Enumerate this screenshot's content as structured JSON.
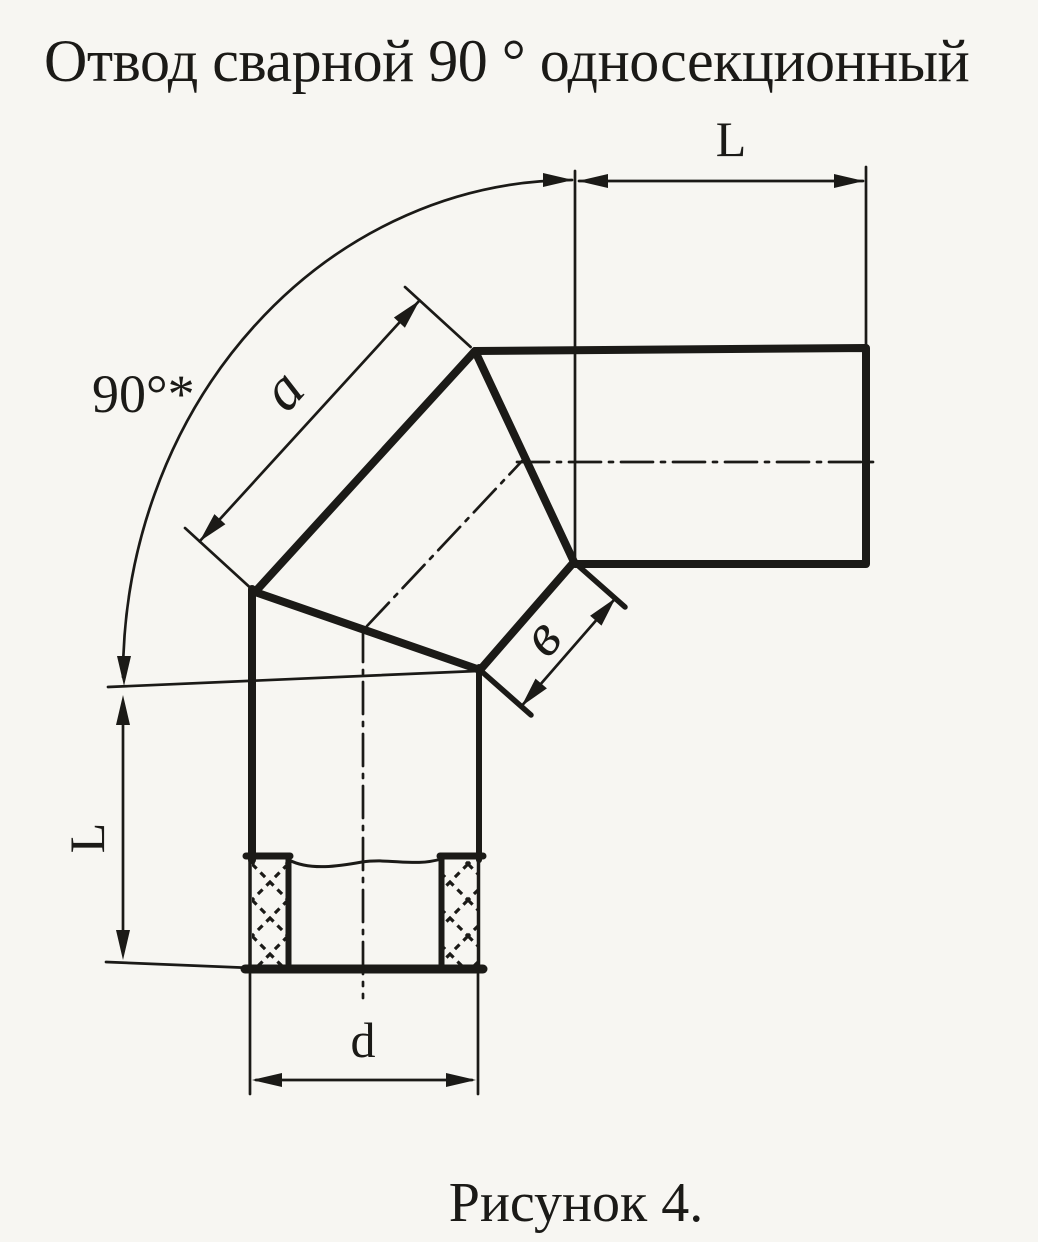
{
  "colors": {
    "ink": "#1b1a17",
    "paper": "#f7f6f2"
  },
  "title": "Отвод сварной 90 ° односекционный",
  "caption": "Рисунок 4.",
  "dims": {
    "angle": "90°*",
    "top_run": "L",
    "left_run": "L",
    "gore_outer": "a",
    "gore_inner": "в",
    "diameter": "d"
  }
}
